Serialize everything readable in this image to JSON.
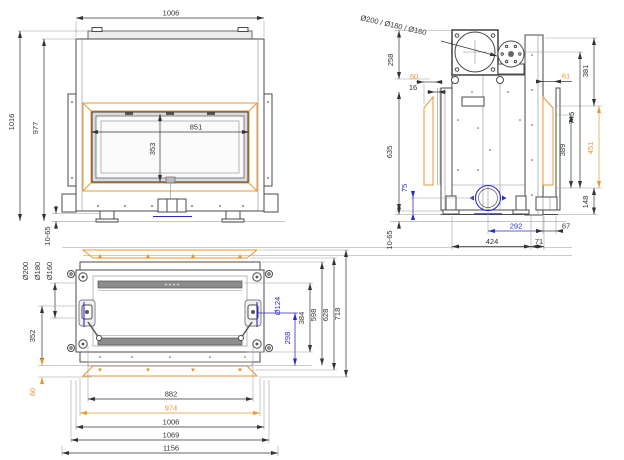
{
  "colors": {
    "line": "#4a4a4a",
    "dim_text": "#333333",
    "accent_orange": "#e8962e",
    "accent_blue": "#2a2ac8"
  },
  "front_view": {
    "top_width": "1006",
    "overall_height": "1016",
    "body_height": "977",
    "glass_width": "851",
    "glass_height": "353",
    "foot_adjust": "10-65"
  },
  "side_view": {
    "flue_label": "Ø200 / Ø180 / Ø160",
    "collar_to_frame": "258",
    "frame_offset": "60",
    "frame_gap": "16",
    "front_height": "635",
    "air_inlet_height": "75",
    "foot_adjust": "10-65",
    "rear_offset": "61",
    "rear_top_height": "381",
    "collar_height": "745",
    "rear_glass_height": "389",
    "rear_frame_height": "451",
    "base_height": "148",
    "air_inlet_depth": "292",
    "rear_overhang": "67",
    "foot_span": "424",
    "rear_foot_offset": "71"
  },
  "plan_view": {
    "flue_labels": [
      "Ø200",
      "Ø180",
      "Ø160"
    ],
    "flue_offset": "352",
    "frame_overhang": "60",
    "air_inlet_dia": "Ø124",
    "air_inlet_pos": "298",
    "inner_depth": "384",
    "body_depth": "598",
    "frame_depth": "628",
    "overall_depth": "718",
    "glass_width": "882",
    "frame_width": "974",
    "body_width": "1006",
    "bracket_width": "1069",
    "overall_width": "1156"
  }
}
